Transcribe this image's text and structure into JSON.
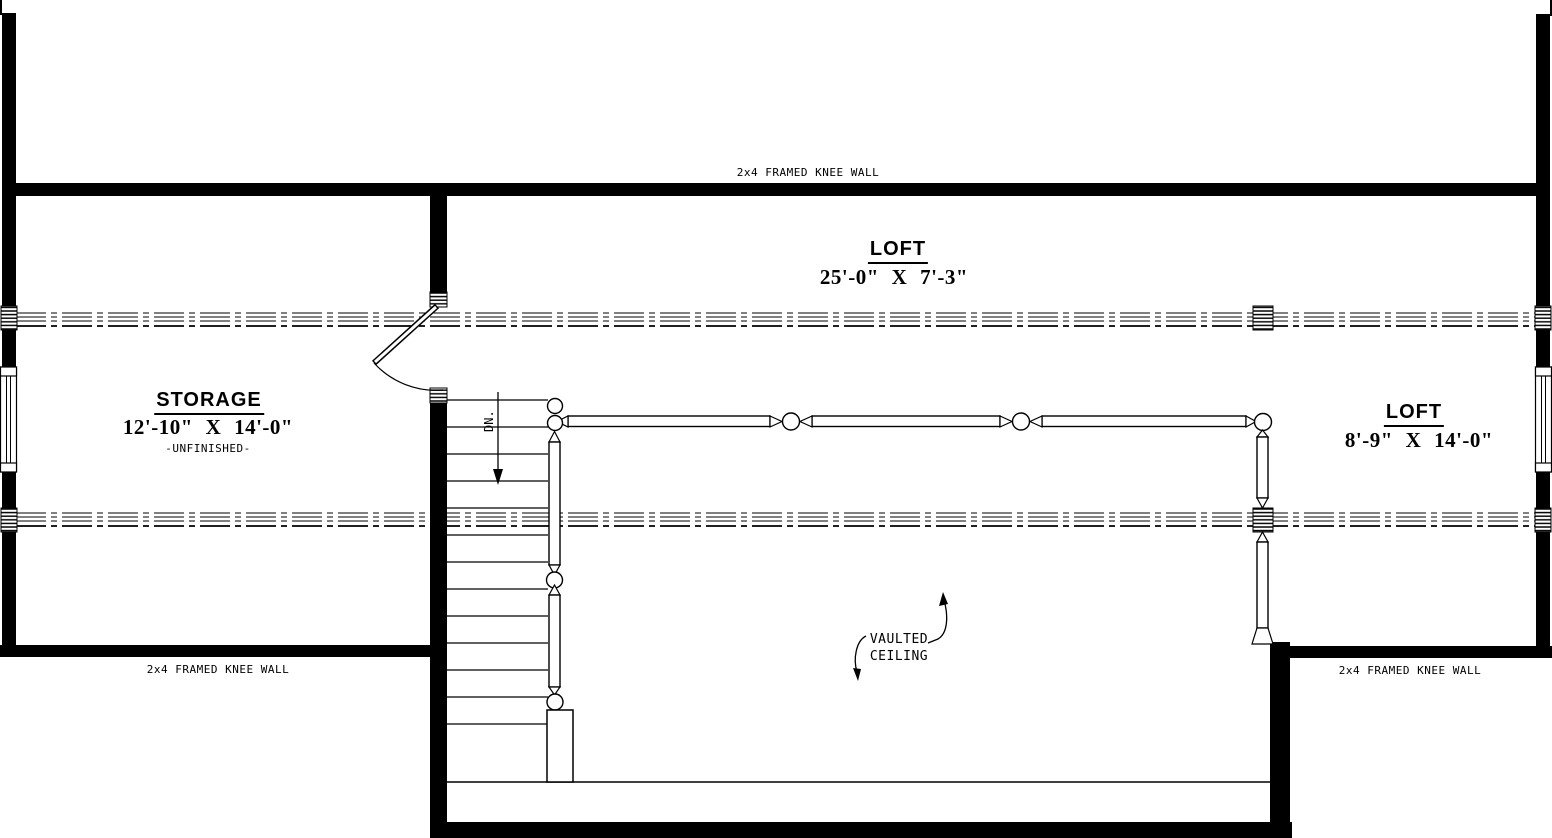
{
  "plan": {
    "annotations": {
      "knee_wall_top": "2x4 FRAMED KNEE WALL",
      "knee_wall_bottom_left": "2x4 FRAMED KNEE WALL",
      "knee_wall_bottom_right": "2x4 FRAMED KNEE WALL",
      "down_label": "DN.",
      "vaulted_ceiling_line1": "VAULTED",
      "vaulted_ceiling_line2": "CEILING"
    },
    "rooms": {
      "loft_main": {
        "name": "LOFT",
        "dimensions": "25'-0\" X 7'-3\""
      },
      "storage": {
        "name": "STORAGE",
        "dimensions": "12'-10\" X 14'-0\"",
        "note": "-UNFINISHED-"
      },
      "loft_right": {
        "name": "LOFT",
        "dimensions": "8'-9\" X 14'-0\""
      }
    },
    "colors": {
      "line": "#000000",
      "background": "#ffffff"
    }
  }
}
